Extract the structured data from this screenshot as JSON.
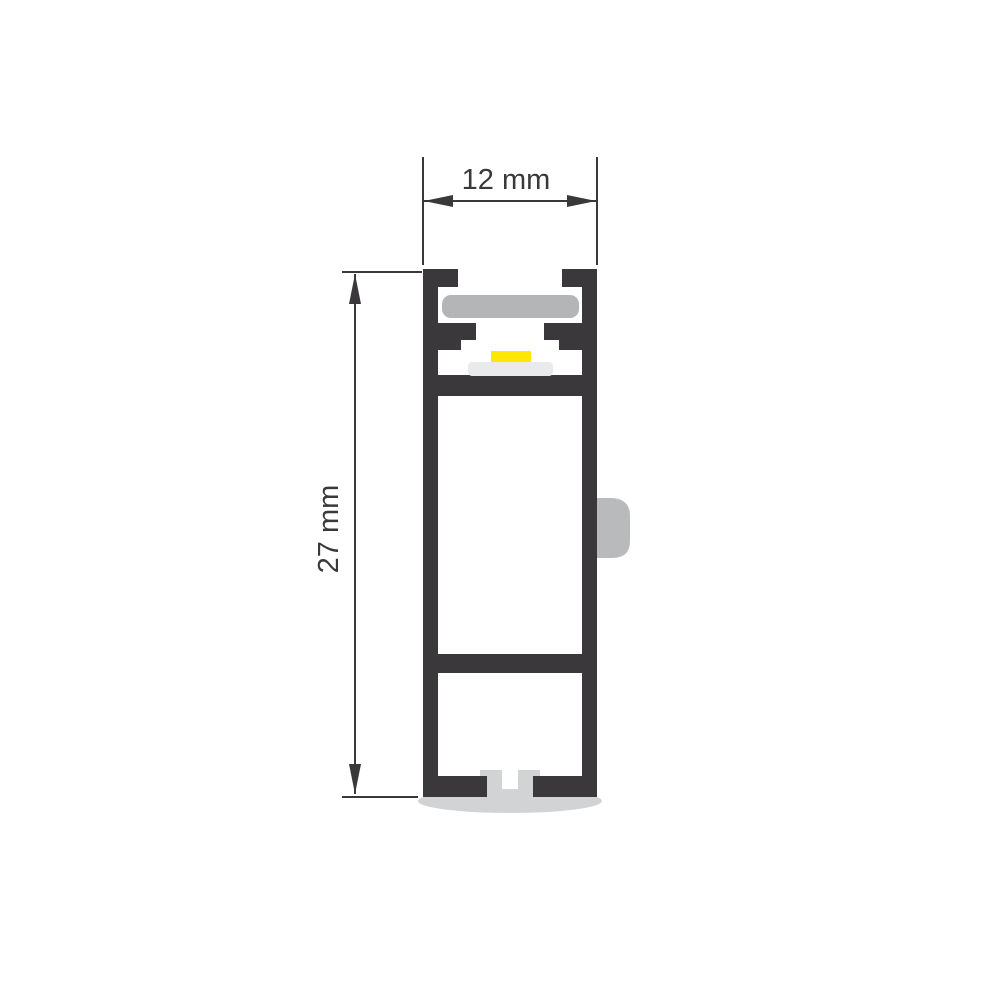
{
  "title": "Aluminium LED profile cross-section, dimensioned drawing",
  "dimensions": {
    "width": {
      "label": "12 mm",
      "value_mm": 12
    },
    "height": {
      "label": "27 mm",
      "value_mm": 27
    }
  },
  "colors": {
    "background": "#ffffff",
    "profile_body": "#3a383a",
    "diffuser": "#b3b5b7",
    "pcb": "#e9eaeb",
    "led": "#ffe605",
    "end_cap": "#d2d3d5",
    "side_clip": "#b9babc",
    "dimension": "#3a383a"
  }
}
